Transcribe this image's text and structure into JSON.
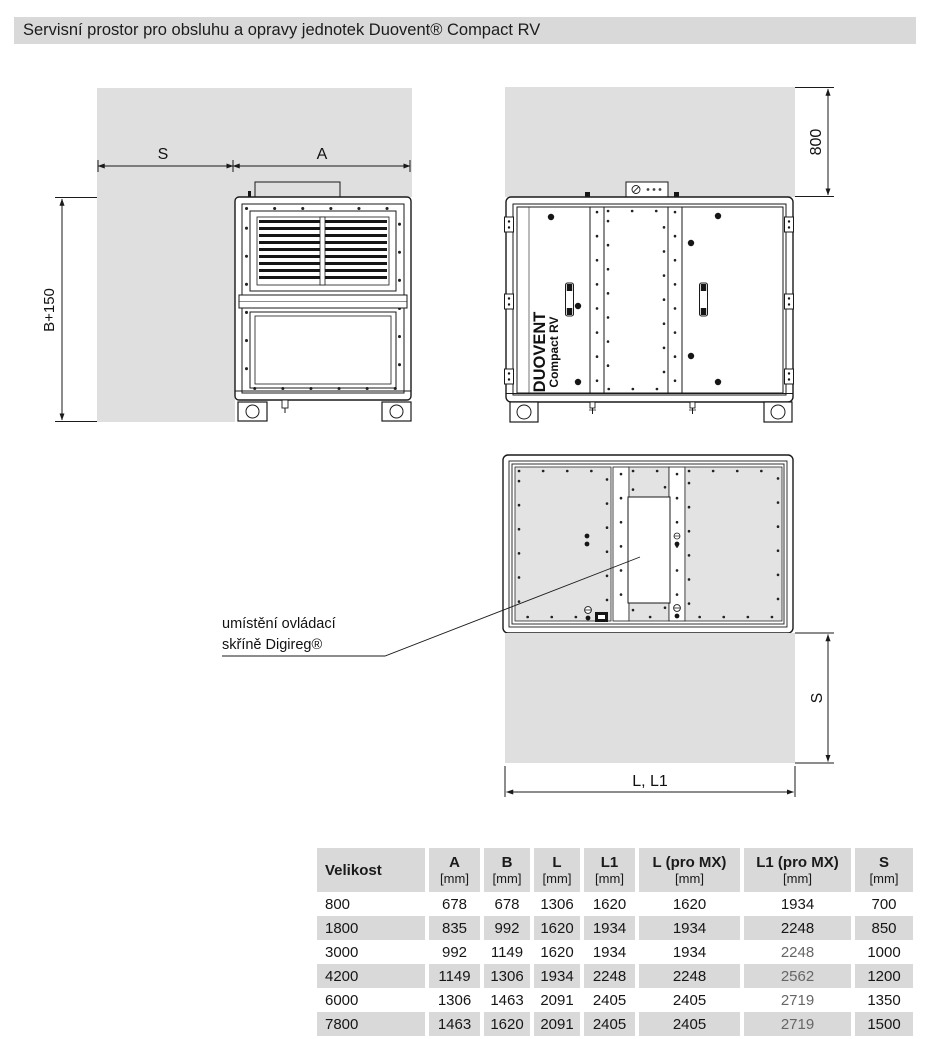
{
  "title": "Servisní prostor pro obsluhu a opravy jednotek Duovent® Compact RV",
  "colors": {
    "service_area": "#dfdfdf",
    "panel_fill": "#e3e3e3",
    "table_stripe": "#d9d9d9",
    "line": "#1a1a1a"
  },
  "diagrams": {
    "side_view": {
      "dim_s": "S",
      "dim_a": "A",
      "dim_height": "B+150"
    },
    "front_view": {
      "dim_top": "800",
      "brand_line1": "DUOVENT",
      "brand_line2": "Compact RV"
    },
    "top_view": {
      "dim_side": "S",
      "dim_bottom": "L, L1",
      "annotation_line1": "umístění ovládací",
      "annotation_line2": "skříně Digireg®"
    }
  },
  "table": {
    "header": [
      {
        "label": "Velikost",
        "unit": ""
      },
      {
        "label": "A",
        "unit": "[mm]"
      },
      {
        "label": "B",
        "unit": "[mm]"
      },
      {
        "label": "L",
        "unit": "[mm]"
      },
      {
        "label": "L1",
        "unit": "[mm]"
      },
      {
        "label": "L (pro MX)",
        "unit": "[mm]"
      },
      {
        "label": "L1 (pro MX)",
        "unit": "[mm]"
      },
      {
        "label": "S",
        "unit": "[mm]"
      }
    ],
    "rows": [
      {
        "cells": [
          "800",
          "678",
          "678",
          "1306",
          "1620",
          "1620",
          "1934",
          "700"
        ],
        "muted_cols": []
      },
      {
        "cells": [
          "1800",
          "835",
          "992",
          "1620",
          "1934",
          "1934",
          "2248",
          "850"
        ],
        "muted_cols": []
      },
      {
        "cells": [
          "3000",
          "992",
          "1149",
          "1620",
          "1934",
          "1934",
          "2248",
          "1000"
        ],
        "muted_cols": [
          6
        ]
      },
      {
        "cells": [
          "4200",
          "1149",
          "1306",
          "1934",
          "2248",
          "2248",
          "2562",
          "1200"
        ],
        "muted_cols": [
          6
        ]
      },
      {
        "cells": [
          "6000",
          "1306",
          "1463",
          "2091",
          "2405",
          "2405",
          "2719",
          "1350"
        ],
        "muted_cols": [
          6
        ]
      },
      {
        "cells": [
          "7800",
          "1463",
          "1620",
          "2091",
          "2405",
          "2405",
          "2719",
          "1500"
        ],
        "muted_cols": [
          6
        ]
      }
    ]
  }
}
